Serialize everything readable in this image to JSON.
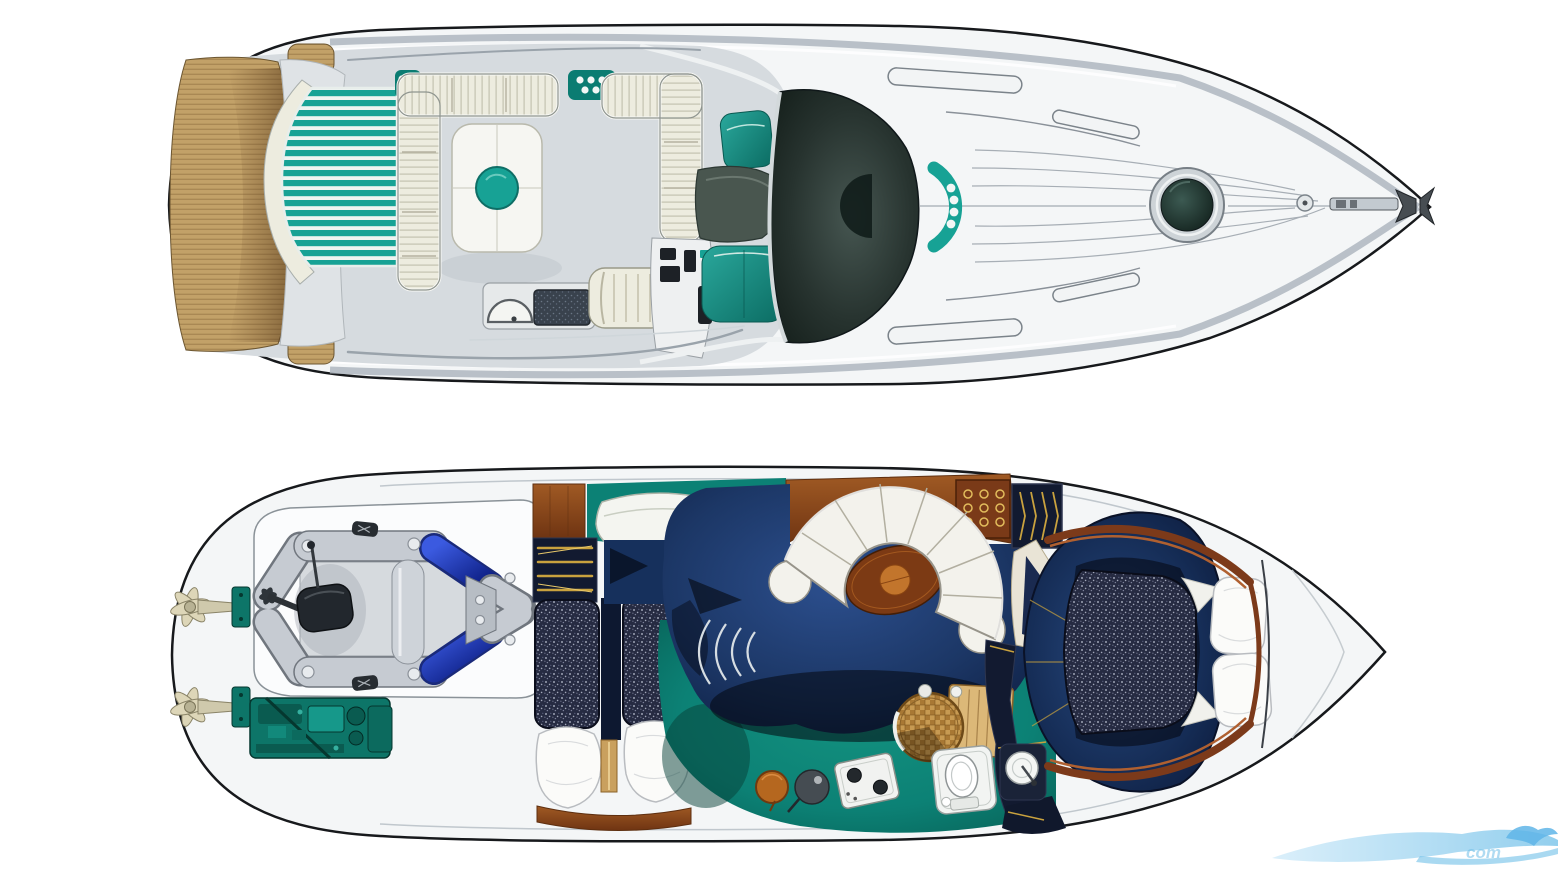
{
  "document": {
    "description": "Illustrated motor-yacht brochure plan: main deck top view above, lower-deck accommodation plan below, bow pointing right",
    "background": "#ffffff"
  },
  "watermark": {
    "text": "com",
    "color": "#6fbfe8"
  },
  "palette": {
    "paper": "#ffffff",
    "outline": "#17191c",
    "hull": "#f4f6f7",
    "hullLine": "#aab3bb",
    "deck": "#d6dbdf",
    "deckLine": "#9aa3ab",
    "silver": "#dfe3e6",
    "teak": "#c2a168",
    "teakLine": "#8a6a3c",
    "teakShadow": "#6b4a26",
    "teal": "#17a295",
    "tealDeep": "#0b7c72",
    "tealStripe": "#eef4f1",
    "cream": "#edecdf",
    "creamLine": "#a9a791",
    "dark": "#1d2a26",
    "windLight": "#465651",
    "navy": "#1c3766",
    "navyDeep": "#0c1b3d",
    "navyPanel": "#121a30",
    "carpet": "#0c8175",
    "carpetDeep": "#065a50",
    "wood": "#8e4a1e",
    "woodDark": "#5e2f10",
    "woodLight": "#c07a36",
    "gold": "#c9a23e",
    "mattress": "#262b42",
    "speck": "#c9cede",
    "blue": "#2448cc",
    "blueDeep": "#0a1b7e",
    "dinghy": "#c6cbd2",
    "dinghyLine": "#70767e",
    "engine": "#0d7568",
    "engineDark": "#05372f",
    "pillow": "#fbfbf9",
    "pillowLine": "#b9bcc0",
    "cushion": "#f3f2ec",
    "cushionLine": "#97948a",
    "grill": "#39424d",
    "wm1": "#a5d8f4",
    "wm2": "#6fbfe8"
  },
  "views": {
    "main_deck": {
      "label": "main-deck-plan",
      "features": [
        "teak swim platform",
        "aft sunpad",
        "cockpit U-sofa",
        "cockpit table",
        "wet bar sink",
        "grill",
        "helm bench",
        "helm console",
        "helm seats",
        "windshield",
        "foredeck grab rails",
        "foredeck sunpad",
        "deck hatch",
        "anchor fitting"
      ]
    },
    "lower_deck": {
      "label": "lower-deck-plan",
      "features": [
        "twin stern drives",
        "tender garage",
        "inflatable dinghy",
        "outboard motor",
        "engine",
        "wardrobe",
        "twin guest berths",
        "salon curved sofa",
        "salon table",
        "companionway steps",
        "galley stove",
        "rattan table",
        "head toilet",
        "head sink",
        "owner double berth",
        "pillows"
      ]
    }
  }
}
